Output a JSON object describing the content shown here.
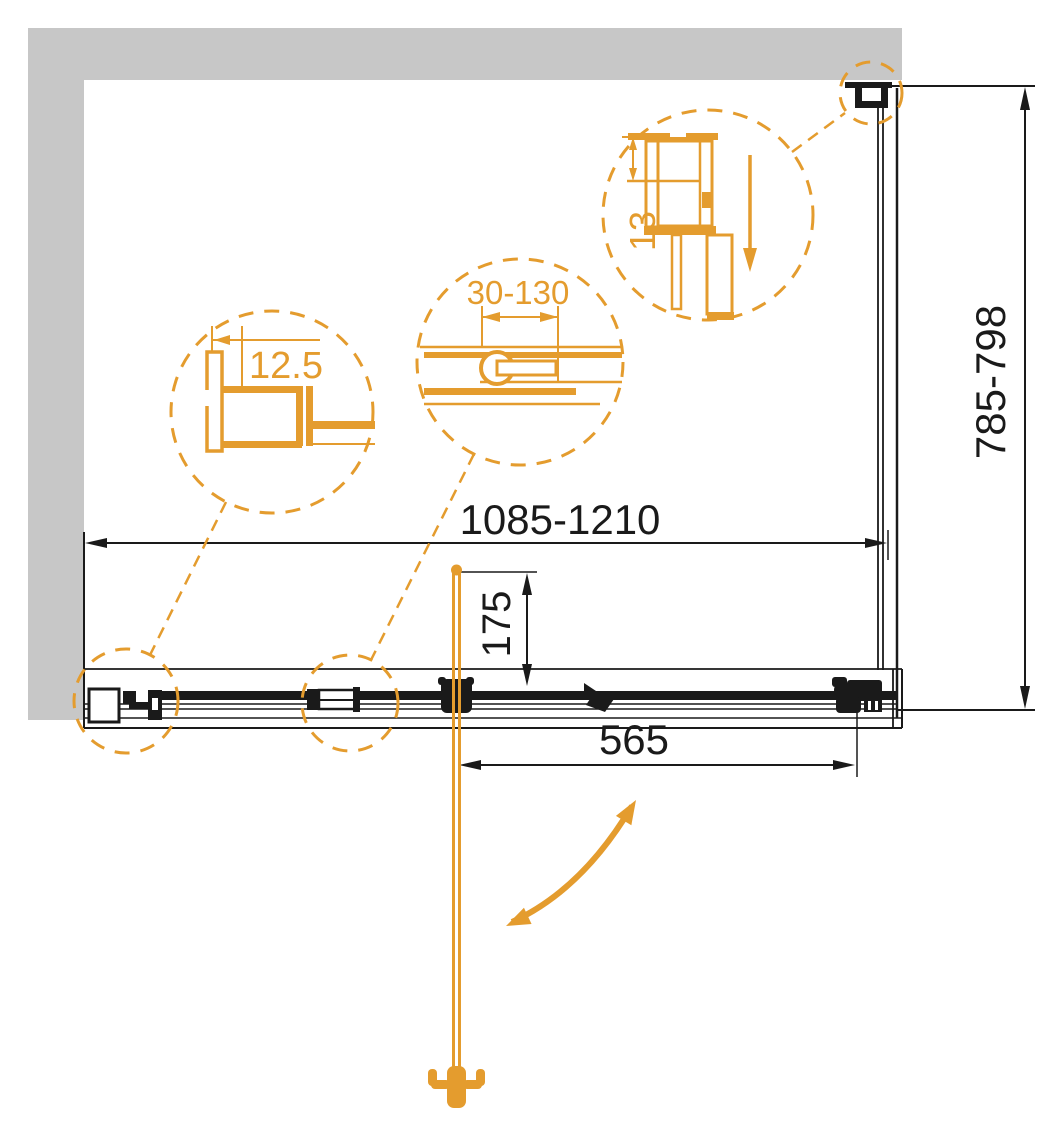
{
  "colors": {
    "accent": "#E49C2E",
    "line": "#1a1a1a",
    "wall": "#C7C7C7",
    "white": "#ffffff"
  },
  "dimensions": {
    "door_width": {
      "label": "1085-1210",
      "unit": "mm",
      "orientation": "horizontal"
    },
    "side_panel_width": {
      "label": "785-798",
      "unit": "mm",
      "orientation": "vertical"
    },
    "handle_to_corner": {
      "label": "565",
      "unit": "mm",
      "orientation": "horizontal"
    },
    "handle_offset": {
      "label": "175",
      "unit": "mm",
      "orientation": "vertical"
    }
  },
  "details": {
    "wall_profile": {
      "label": "12.5"
    },
    "adjustment_range": {
      "label": "30-130"
    },
    "corner_profile": {
      "label": "13"
    }
  },
  "icons": {
    "swing_arrow": "curved-double-headed-arrow",
    "slide_arrow": "down-arrow",
    "towel_hook": "double-hook",
    "detail_circles": "dashed-callout-circle"
  }
}
